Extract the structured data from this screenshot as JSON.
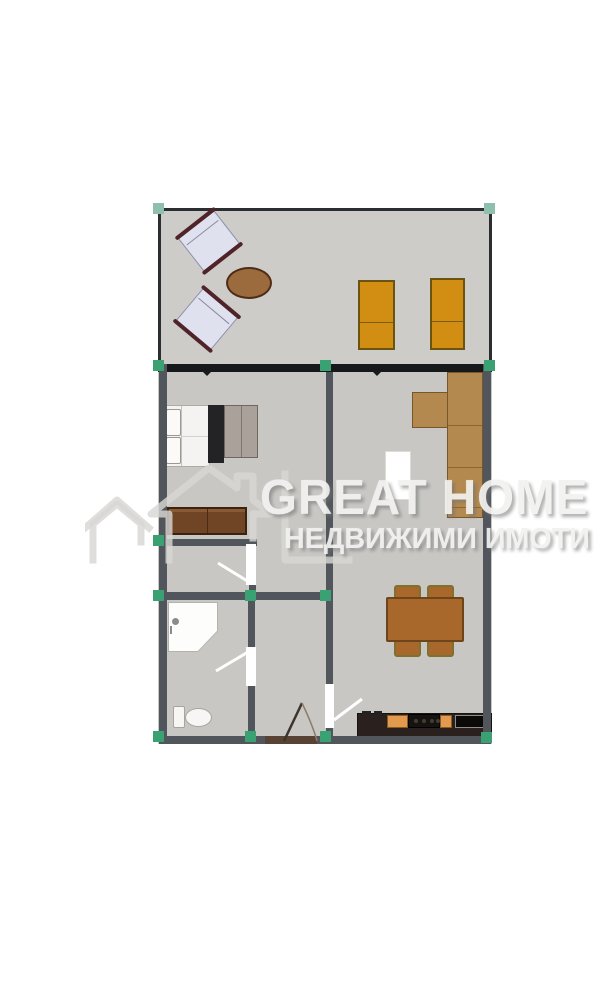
{
  "watermark": {
    "title": "GREAT HOME",
    "subtitle": "НЕДВИЖИМИ ИМОТИ"
  },
  "colors": {
    "page_bg": "#ffffff",
    "floor": "#c8c7c4",
    "terrace_floor": "#cdccc9",
    "wall": "#51565c",
    "window_band": "#17181a",
    "marker": "#3aa173",
    "sofa": "#b3894f",
    "lounger": "#d28e12",
    "wood_table": "#a8682c",
    "counter": "#2a211e",
    "accent_orange": "#e29a4e",
    "watermark_text": "#f2f2f0"
  },
  "furniture": [
    "armchair",
    "armchair",
    "round-table",
    "sun-lounger",
    "sun-lounger",
    "double-bed",
    "wardrobe",
    "wardrobe",
    "dresser",
    "corner-sofa",
    "side-table",
    "dining-table",
    "dining-chair",
    "shower-cabin",
    "toilet",
    "kitchen-counter",
    "stove",
    "sink"
  ]
}
